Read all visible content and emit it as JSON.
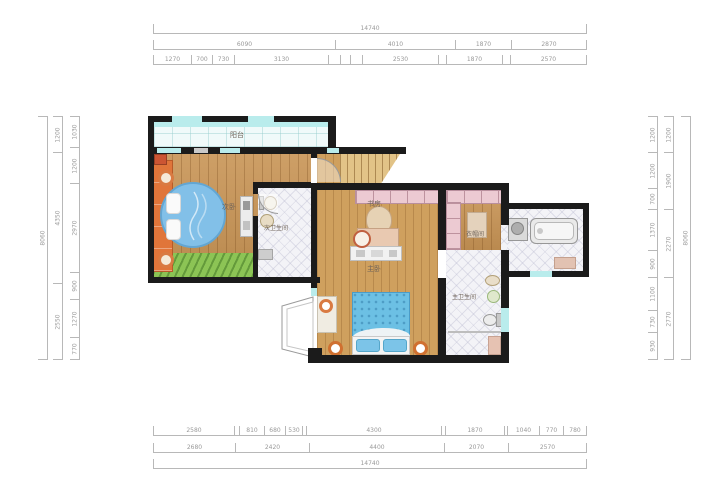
{
  "rooms": {
    "balcony": "阳台",
    "secondary_bedroom": "次卧",
    "secondary_bathroom": "次卫生间",
    "study": "书房",
    "master_bedroom": "主卧",
    "cloakroom": "衣帽间",
    "master_bathroom": "主卫生间"
  },
  "palette": {
    "wall": "#1b1b1b",
    "wood_floor": "#c89455",
    "tile_floor": "#f3f3f7",
    "balcony_floor": "#f0fafa",
    "window_cyan": "#b9ecec",
    "wardrobe_orange": "#e0753a",
    "bed_blue": "#82c0e8",
    "mat_green": "#8cc455",
    "cabinet_pink": "#eccad2",
    "stairs_tan": "#e2c387",
    "dim_line": "#b8b8b8",
    "dim_text": "#9a9a9a"
  },
  "dimensions": {
    "top_total": {
      "segments": [
        {
          "w": 434,
          "v": "14740"
        }
      ]
    },
    "top_groups": {
      "segments": [
        {
          "w": 182,
          "v": "6090"
        },
        {
          "w": 120,
          "v": "4010"
        },
        {
          "w": 56,
          "v": "1870"
        },
        {
          "w": 76,
          "v": "2870"
        }
      ]
    },
    "top_detail": {
      "segments": [
        {
          "w": 38,
          "v": "1270"
        },
        {
          "w": 21,
          "v": "700"
        },
        {
          "w": 22,
          "v": "730"
        },
        {
          "w": 94,
          "v": "3130"
        },
        {
          "w": 12,
          "v": ""
        },
        {
          "w": 10,
          "v": ""
        },
        {
          "w": 12,
          "v": ""
        },
        {
          "w": 76,
          "v": "2530"
        },
        {
          "w": 8,
          "v": ""
        },
        {
          "w": 56,
          "v": "1870"
        },
        {
          "w": 8,
          "v": ""
        },
        {
          "w": 77,
          "v": "2570"
        }
      ]
    },
    "bottom_detail": {
      "segments": [
        {
          "w": 81,
          "v": "2580"
        },
        {
          "w": 5,
          "v": ""
        },
        {
          "w": 25,
          "v": "810"
        },
        {
          "w": 21,
          "v": "680"
        },
        {
          "w": 17,
          "v": "530"
        },
        {
          "w": 4,
          "v": ""
        },
        {
          "w": 135,
          "v": "4300"
        },
        {
          "w": 4,
          "v": ""
        },
        {
          "w": 59,
          "v": "1870"
        },
        {
          "w": 3,
          "v": ""
        },
        {
          "w": 32,
          "v": "1040"
        },
        {
          "w": 24,
          "v": "770"
        },
        {
          "w": 24,
          "v": "780"
        }
      ]
    },
    "bottom_groups": {
      "segments": [
        {
          "w": 82,
          "v": "2680"
        },
        {
          "w": 74,
          "v": "2420"
        },
        {
          "w": 135,
          "v": "4400"
        },
        {
          "w": 64,
          "v": "2070"
        },
        {
          "w": 79,
          "v": "2570"
        }
      ]
    },
    "bottom_total": {
      "segments": [
        {
          "w": 434,
          "v": "14740"
        }
      ]
    },
    "left_detail": {
      "segments": [
        {
          "w": 31,
          "v": "1030"
        },
        {
          "w": 36,
          "v": "1200"
        },
        {
          "w": 89,
          "v": "2970"
        },
        {
          "w": 27,
          "v": "900"
        },
        {
          "w": 38,
          "v": "1270"
        },
        {
          "w": 23,
          "v": "770"
        }
      ]
    },
    "left_outer": {
      "segments": [
        {
          "w": 36,
          "v": "1200"
        },
        {
          "w": 131,
          "v": "4350"
        },
        {
          "w": 77,
          "v": "2550"
        }
      ]
    },
    "left_total": {
      "segments": [
        {
          "w": 244,
          "v": "8060"
        }
      ]
    },
    "right_detail": {
      "segments": [
        {
          "w": 36,
          "v": "1200"
        },
        {
          "w": 36,
          "v": "1200"
        },
        {
          "w": 21,
          "v": "700"
        },
        {
          "w": 41,
          "v": "1370"
        },
        {
          "w": 27,
          "v": "900"
        },
        {
          "w": 33,
          "v": "1100"
        },
        {
          "w": 22,
          "v": "730"
        },
        {
          "w": 28,
          "v": "930"
        }
      ]
    },
    "right_outer": {
      "segments": [
        {
          "w": 36,
          "v": "1200"
        },
        {
          "w": 57,
          "v": "1900"
        },
        {
          "w": 68,
          "v": "2270"
        },
        {
          "w": 83,
          "v": "2770"
        }
      ]
    },
    "right_total": {
      "segments": [
        {
          "w": 244,
          "v": "8060"
        }
      ]
    }
  }
}
